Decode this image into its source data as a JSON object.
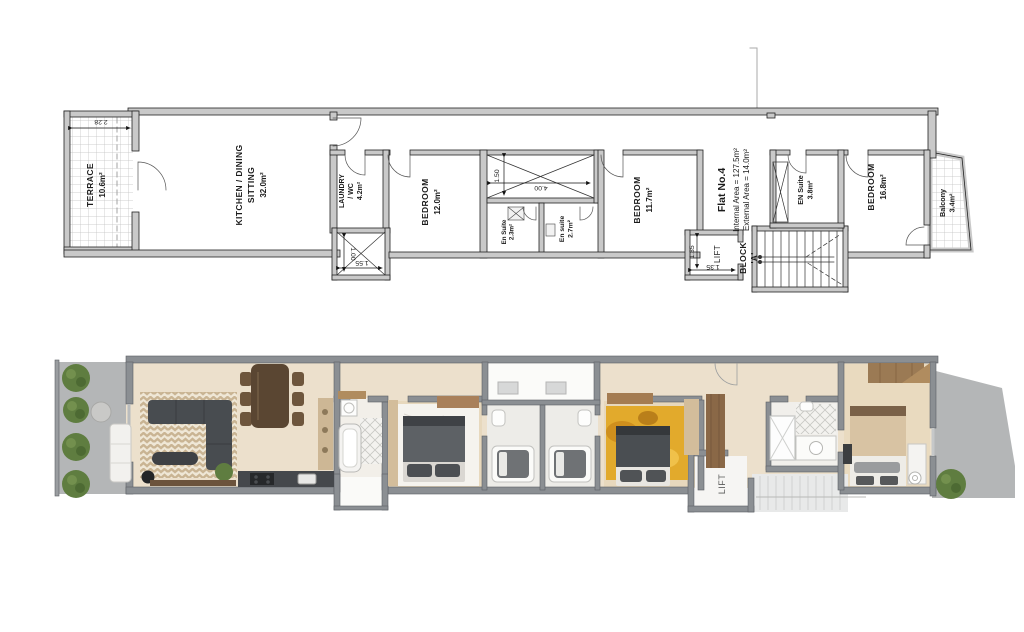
{
  "plan": {
    "terrace": {
      "name": "TERRACE",
      "area": "10.6m²",
      "dim": "2.28"
    },
    "kitchen": {
      "line1": "KITCHEN / DINING",
      "line2": "SITTING",
      "area": "32.0m²"
    },
    "laundry": {
      "line1": "LAUNDRY",
      "line2": "/ WC",
      "area": "4.2m²"
    },
    "shaft": {
      "h": "1.00",
      "w": "1.55"
    },
    "bedroom1": {
      "name": "BEDROOM",
      "area": "12.0m²"
    },
    "lightwell": {
      "h": "1.50",
      "w": "4.00"
    },
    "ensuite1": {
      "name": "En Suite",
      "area": "2.3m²"
    },
    "ensuite2": {
      "name": "En suite",
      "area": "2.7m²"
    },
    "bedroom2": {
      "name": "BEDROOM",
      "area": "11.7m²"
    },
    "flat": {
      "no": "Flat No.4",
      "internal": "Internal Area  =  127.5m²",
      "external": "External Area =   14.0m²"
    },
    "lift": {
      "name": "LIFT",
      "w": "1.35",
      "h": "1.35"
    },
    "block": {
      "line1": "BLOCK",
      "line2": "'A'"
    },
    "ensuite3": {
      "name": "EN Suite",
      "area": "3.8m²"
    },
    "bedroom3": {
      "name": "BEDROOM",
      "area": "16.8m²"
    },
    "balcony": {
      "name": "Balcony",
      "area": "3.4m²"
    }
  },
  "render": {
    "lift": "LIFT"
  },
  "colors": {
    "plan_wall": "#c9c9c9",
    "render_wall": "#8b8f93",
    "floor_cream": "#ece0cc",
    "floor_tan": "#e7d8bd",
    "terrace_gray": "#b4b6b7",
    "rug_yellow": "#e2aa2c",
    "sofa_dark": "#484c50",
    "bush_green": "#5f7d40",
    "wood": "#8a6a49"
  }
}
